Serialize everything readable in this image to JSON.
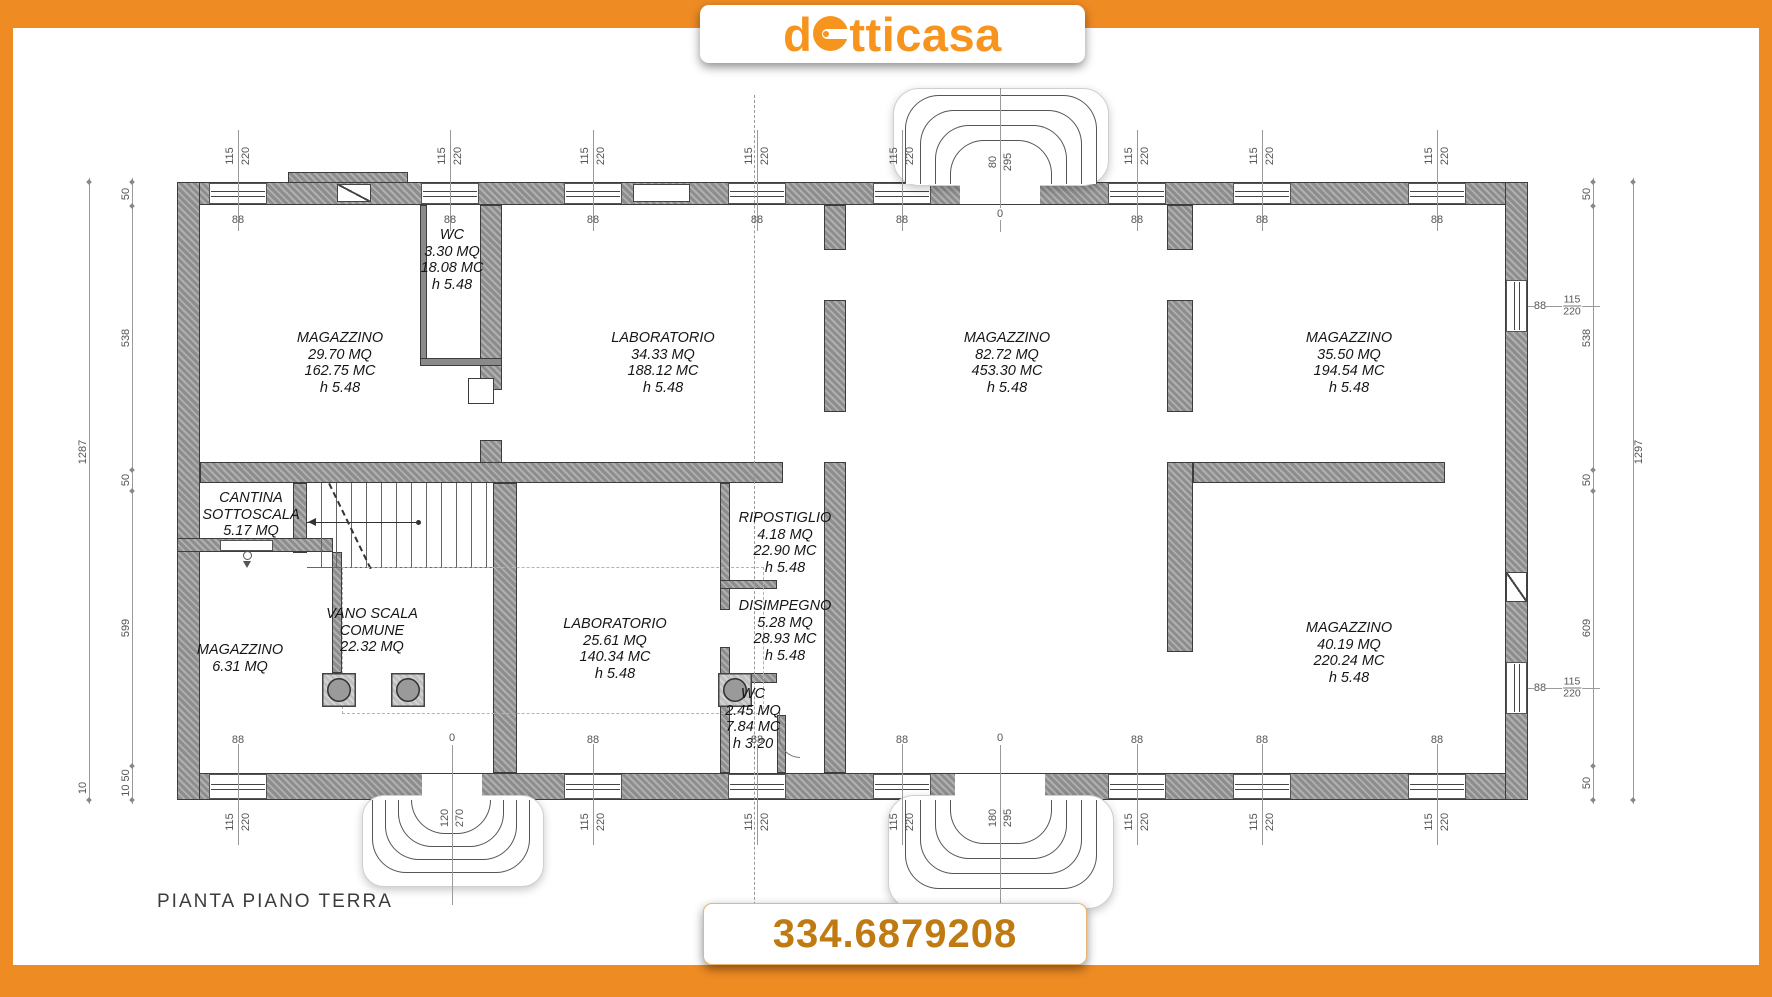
{
  "brand": {
    "logo_prefix": "d",
    "logo_suffix": "tticasa",
    "logo_full": "dotticasa"
  },
  "phone": "334.6879208",
  "plan_title": "PIANTA PIANO TERRA",
  "rooms": {
    "magazzino_nw": {
      "name": "MAGAZZINO",
      "area": "29.70 MQ",
      "volume": "162.75 MC",
      "height": "h 5.48"
    },
    "wc_top": {
      "name": "WC",
      "area": "3.30 MQ",
      "volume": "18.08 MC",
      "height": "h 5.48"
    },
    "laboratorio_top": {
      "name": "LABORATORIO",
      "area": "34.33 MQ",
      "volume": "188.12 MC",
      "height": "h 5.48"
    },
    "magazzino_center": {
      "name": "MAGAZZINO",
      "area": "82.72 MQ",
      "volume": "453.30 MC",
      "height": "h 5.48"
    },
    "magazzino_ne": {
      "name": "MAGAZZINO",
      "area": "35.50 MQ",
      "volume": "194.54 MC",
      "height": "h 5.48"
    },
    "cantina": {
      "name_line1": "CANTINA",
      "name_line2": "SOTTOSCALA",
      "area": "5.17 MQ"
    },
    "vano_scala": {
      "name_line1": "VANO SCALA",
      "name_line2": "COMUNE",
      "area": "22.32 MQ"
    },
    "magazzino_w": {
      "name": "MAGAZZINO",
      "area": "6.31 MQ"
    },
    "laboratorio_bot": {
      "name": "LABORATORIO",
      "area": "25.61 MQ",
      "volume": "140.34 MC",
      "height": "h 5.48"
    },
    "ripostiglio": {
      "name": "RIPOSTIGLIO",
      "area": "4.18 MQ",
      "volume": "22.90 MC",
      "height": "h 5.48"
    },
    "disimpegno": {
      "name": "DISIMPEGNO",
      "area": "5.28 MQ",
      "volume": "28.93 MC",
      "height": "h 5.48"
    },
    "wc_bottom": {
      "name": "WC",
      "area": "2.45 MQ",
      "volume": "7.84 MC",
      "height": "h 3.20"
    },
    "magazzino_se": {
      "name": "MAGAZZINO",
      "area": "40.19 MQ",
      "volume": "220.24 MC",
      "height": "h 5.48"
    }
  },
  "dims": {
    "left_total": "1287",
    "left_seg1": "50",
    "left_seg2": "538",
    "left_seg3": "50",
    "left_seg4": "599",
    "left_seg5": "10 50",
    "left_extra": "10",
    "right_total": "1297",
    "right_seg1": "50",
    "right_seg2": "538",
    "right_seg3": "50",
    "right_seg4": "609",
    "right_seg5": "50",
    "window_width": "115",
    "window_height": "220",
    "sill_height": "88",
    "zero": "0",
    "entrance_top_w": "80",
    "entrance_top_h": "295",
    "entrance_bottom_w": "180",
    "entrance_bottom_h": "295",
    "entrance_side_w": "120",
    "entrance_side_h": "270"
  },
  "colors": {
    "frame_orange": "#ee8b23",
    "logo_orange": "#f6941d",
    "phone_orange": "#c07a12"
  }
}
